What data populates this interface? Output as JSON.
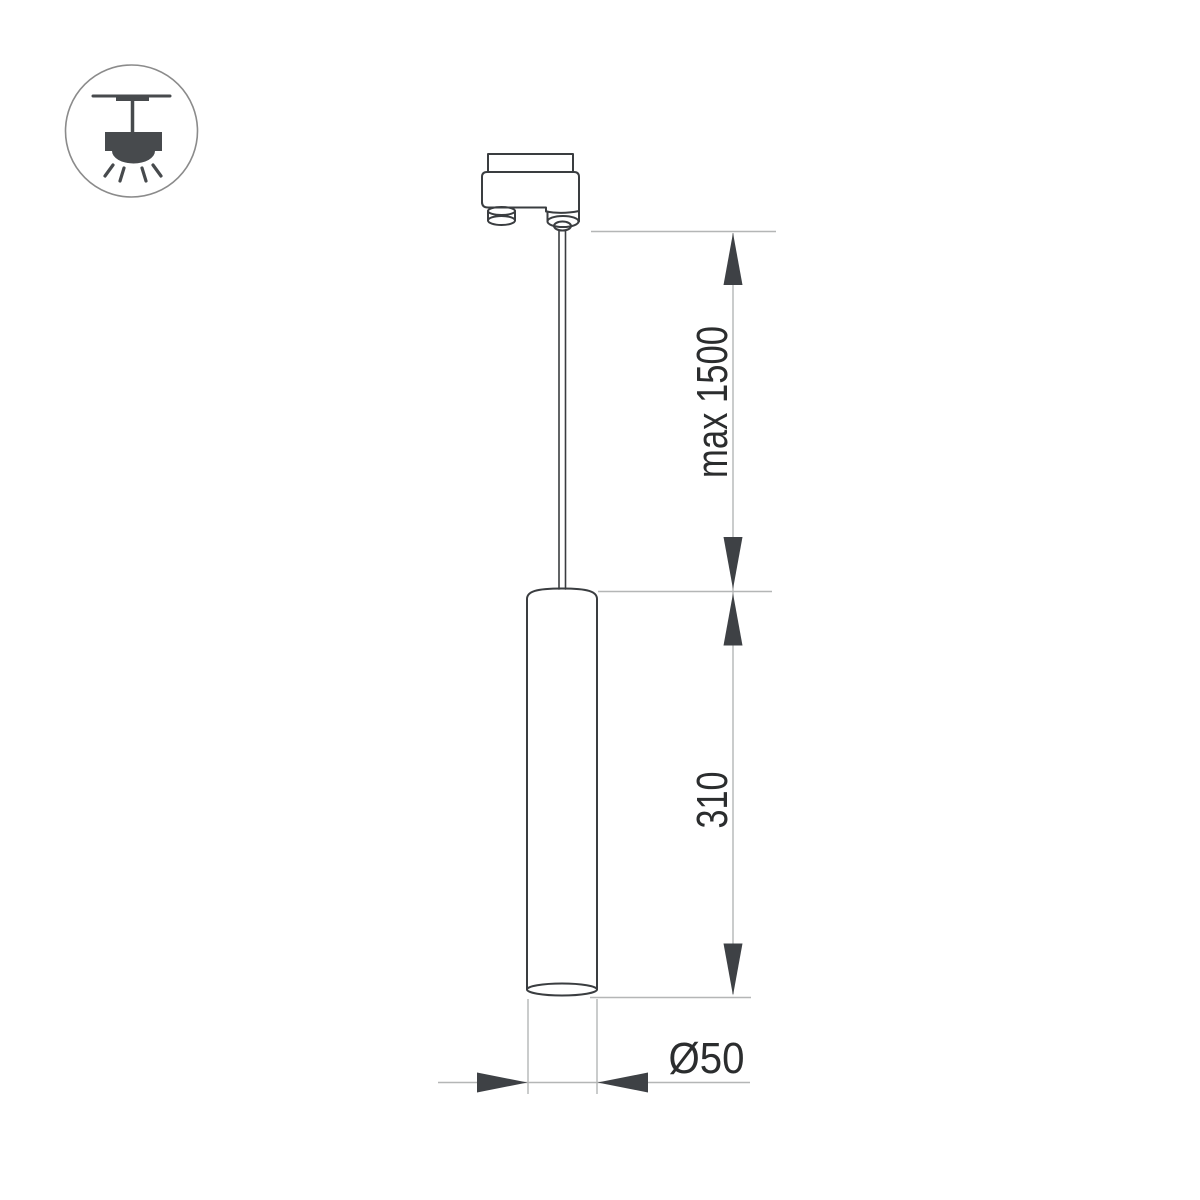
{
  "drawing": {
    "kind": "pendant track luminaire dimension drawing",
    "dimension_labels": {
      "suspension": "max 1500",
      "body_height": "310",
      "diameter": "Ø50"
    },
    "icon": {
      "legend": "ceiling-track-pendant-icon"
    },
    "colors": {
      "background": "#ffffff",
      "outline": "#3a3d40",
      "dimension_line": "#b4b6b6",
      "arrowhead": "#3e4145",
      "label_text": "#2b2d2e",
      "icon_glyph": "#474a4d",
      "icon_circle": "#8b8b8b"
    }
  }
}
